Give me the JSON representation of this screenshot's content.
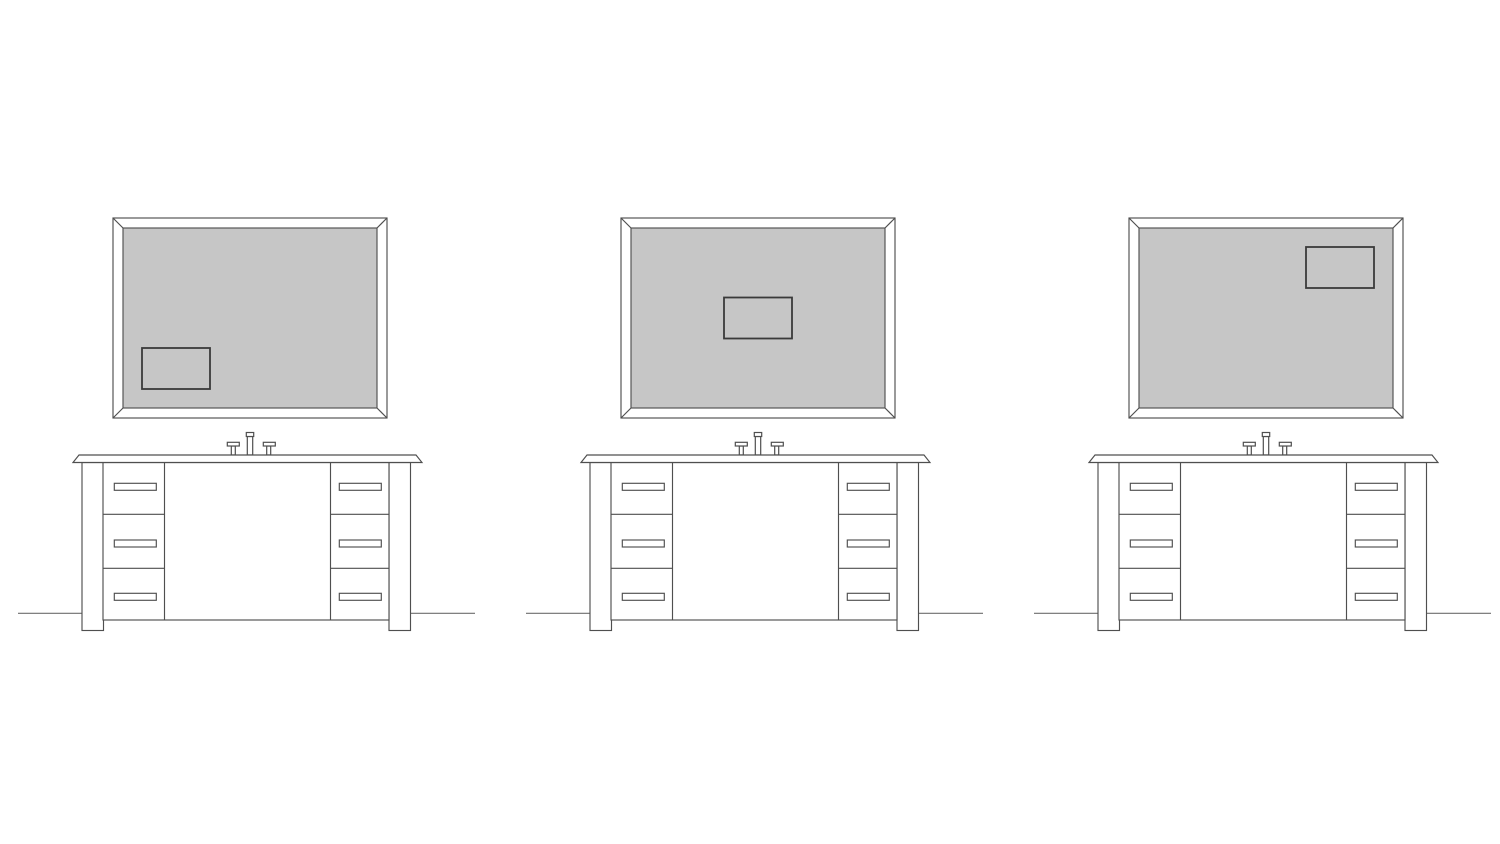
{
  "scene": {
    "width": 1500,
    "height": 844,
    "background": "#ffffff",
    "description": "three-bathroom-vanity-elevation-line-drawings"
  },
  "colors": {
    "outline": "#4f4f4f",
    "floor_line": "#6e6e6e",
    "mirror_glass_fill": "#c6c6c6",
    "reflection_outline": "#3a3a3a",
    "white_fill": "#ffffff"
  },
  "units": [
    {
      "id": "vanity-unit-left",
      "offset_x": 0,
      "reflection_position": "bottom-left"
    },
    {
      "id": "vanity-unit-middle",
      "offset_x": 508,
      "reflection_position": "center"
    },
    {
      "id": "vanity-unit-right",
      "offset_x": 1016,
      "reflection_position": "top-right"
    }
  ],
  "reflection_rect": {
    "width": 68,
    "height": 41,
    "margin": 19
  },
  "drawers_per_side": 3
}
